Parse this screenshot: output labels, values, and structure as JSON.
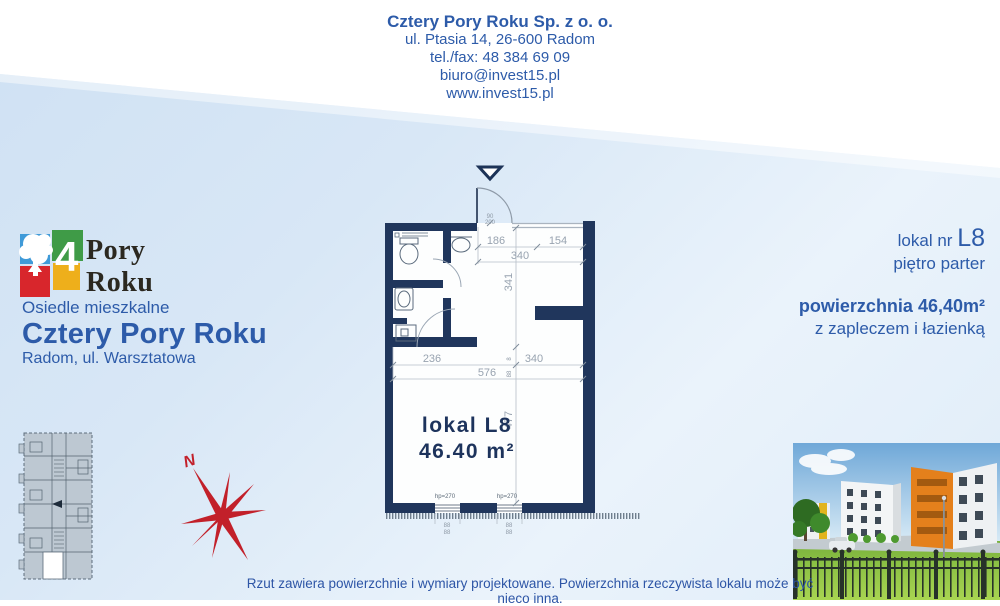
{
  "header": {
    "company": "Cztery Pory Roku Sp. z o. o.",
    "address": "ul. Ptasia 14, 26-600 Radom",
    "phone": "tel./fax: 48 384 69 09",
    "email": "biuro@invest15.pl",
    "website": "www.invest15.pl"
  },
  "logo": {
    "number": "4",
    "word1": "Pory",
    "word2": "Roku",
    "colors": {
      "blue": "#3f9ad8",
      "green": "#3f9b47",
      "red": "#d8262c",
      "yellow": "#eeaf1b"
    }
  },
  "project": {
    "type_label": "Osiedle mieszkalne",
    "name": "Cztery Pory Roku",
    "location": "Radom, ul. Warsztatowa"
  },
  "unit_info": {
    "lokal_prefix": "lokal nr ",
    "lokal_number": "L8",
    "floor": "piętro parter",
    "area": "powierzchnia 46,40m²",
    "note": "z zapleczem i łazienką"
  },
  "floor_plan": {
    "unit_label": "lokal L8",
    "area": "46.40 m²",
    "dims": {
      "d186": "186",
      "d154": "154",
      "d340a": "340",
      "d341": "341",
      "d236": "236",
      "d340b": "340",
      "d576": "576",
      "d477": "477",
      "d8": "8",
      "d88": "88",
      "door_w": "90",
      "door_h": "200",
      "hp1": "hp=270",
      "hp2": "hp=270",
      "win1_a": "88",
      "win1_b": "88",
      "win2_a": "88",
      "win2_b": "88"
    },
    "wall_color": "#20365c",
    "dim_color": "#98a3b0"
  },
  "compass": {
    "north_label": "N",
    "color": "#c2202a"
  },
  "footer": {
    "disclaimer": "Rzut zawiera powierzchnie i wymiary projektowane. Powierzchnia rzeczywista lokalu może być nieco inna."
  }
}
